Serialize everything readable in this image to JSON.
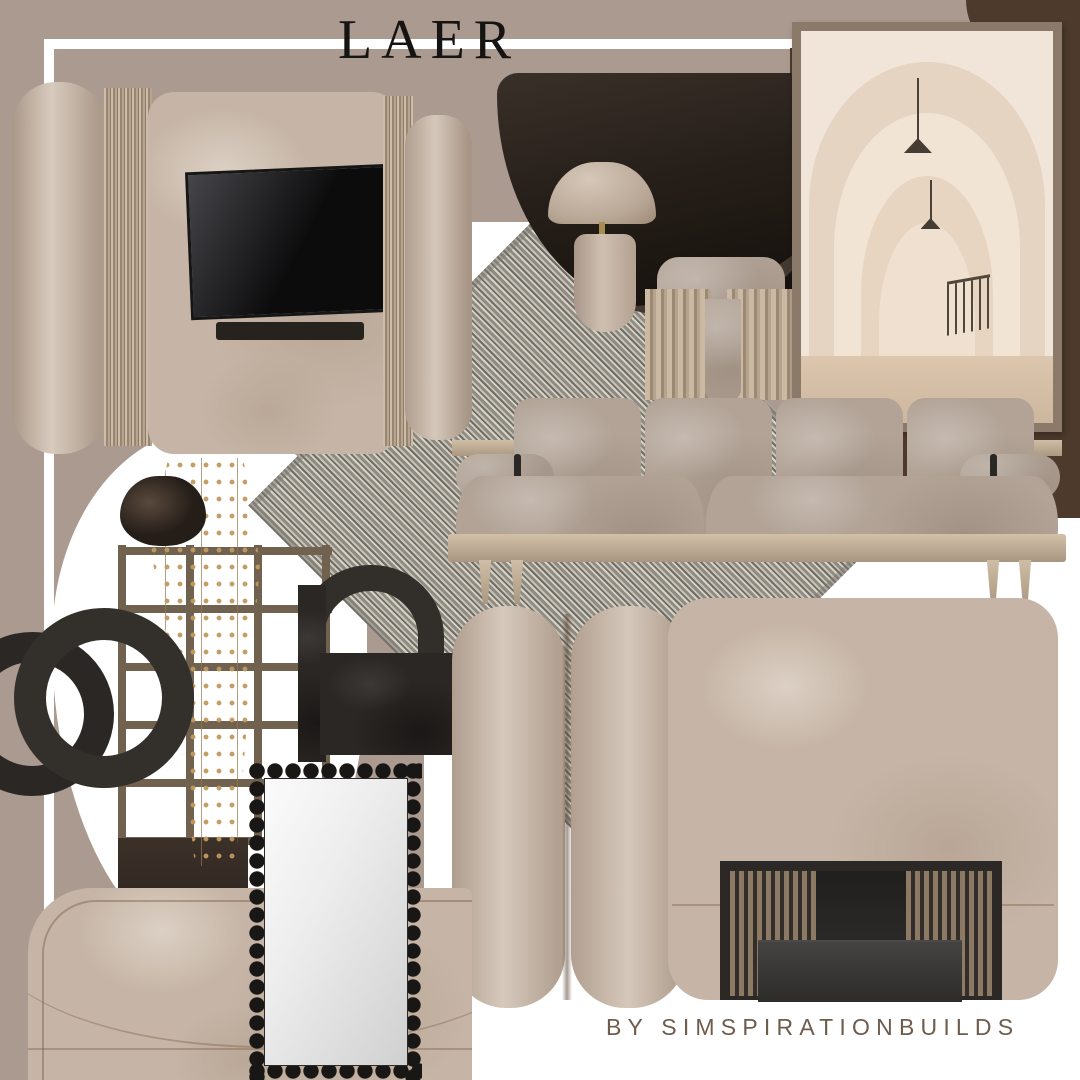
{
  "title": "LAER",
  "credit": "BY SIMSPIRATIONBUILDS",
  "palette": {
    "background_taupe": "#ab9a90",
    "background_white": "#ffffff",
    "accent_dark_brown": "#4d3a2c",
    "stone_beige": "#c6b5a6",
    "charcoal_black": "#2b2724",
    "wood_tan": "#a4917c",
    "fabric_taupe": "#b2a396",
    "rug_gray": "#a3a09a",
    "frame_tan": "#8b7a6a",
    "photo_cream": "#f0e5d8",
    "vine_gold": "#c09a5e",
    "title_text": "#161412",
    "credit_text": "#6e5c4d"
  }
}
